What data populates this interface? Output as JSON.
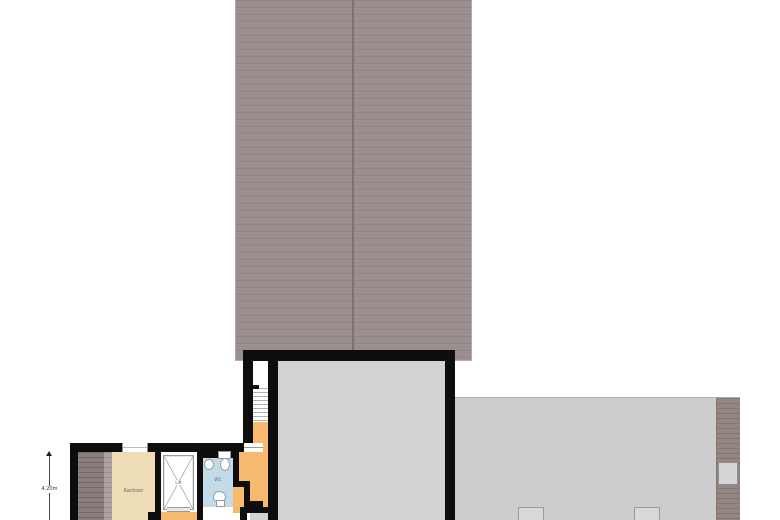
{
  "meta": {
    "drawing_type": "floor-plan",
    "background": "#ffffff"
  },
  "labels": {
    "office_room": "Kantoor",
    "elevator": "Lift",
    "toilet_room": "WC"
  },
  "dimension": {
    "height_label": "4.20m"
  },
  "colors": {
    "roof": "#9a8e8e",
    "roof_ridge": "#7d7171",
    "adjacent_roof": "#cdcdcd",
    "adjacent_roof_edge": "#948683",
    "wall": "#0d0d0d",
    "main_room_floor": "#d2d2d2",
    "hallway_floor": "#f6b96e",
    "office_floor": "#eedcb7",
    "toilet_floor": "#c5dae9",
    "stairs_down": "#8c7e7e",
    "fixture_border": "#8fa0ad"
  }
}
